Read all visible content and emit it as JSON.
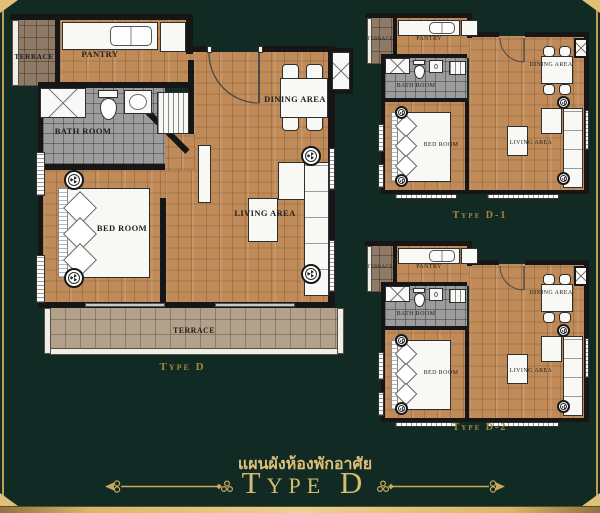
{
  "colors": {
    "background": "#112b24",
    "gold_accent": "#d9bb6e",
    "gold_label": "#a5873c",
    "wood_floor": "#c08b58",
    "terrace_tile": "#b3a18b",
    "bath_tile": "#9c9c9c",
    "wall": "#161616",
    "room_label_text": "#1f1f1f"
  },
  "plans": {
    "main": {
      "title": "Type D",
      "rooms": {
        "terrace_top": "TERRACE",
        "pantry": "PANTRY",
        "bath": "BATH ROOM",
        "bed": "BED ROOM",
        "dining": "DINING AREA",
        "living": "LIVING AREA",
        "terrace_bottom": "TERRACE"
      }
    },
    "d1": {
      "title": "Type D-1",
      "rooms": {
        "terrace": "TERRACE",
        "pantry": "PANTRY",
        "bath": "BATH ROOM",
        "bed": "BED ROOM",
        "dining": "DINING AREA",
        "living": "LIVING AREA"
      }
    },
    "d2": {
      "title": "Type D-2",
      "rooms": {
        "terrace": "TERRACE",
        "pantry": "PANTRY",
        "bath": "BATH ROOM",
        "bed": "BED ROOM",
        "dining": "DINING AREA",
        "living": "LIVING AREA"
      }
    }
  },
  "footer": {
    "subtitle_thai": "แผนผังห้องพักอาศัย",
    "title": "Type D"
  }
}
